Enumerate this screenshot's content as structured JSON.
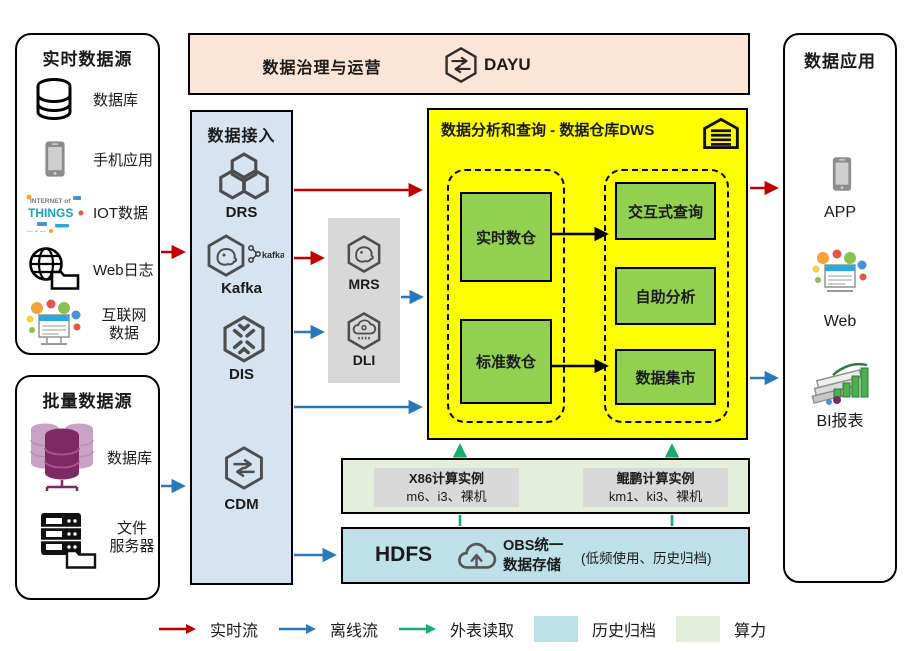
{
  "colors": {
    "realtime_flow": "#C00000",
    "offline_flow": "#2878BE",
    "external_read": "#16AD70",
    "archive_fill": "#BEE0E8",
    "compute_fill": "#E3EFDA",
    "dws_fill": "#FEFE00",
    "module_green": "#92D050",
    "governance_fill": "#FBE5D6",
    "ingest_fill": "#D6E3F1",
    "processing_fill": "#D8D8D8"
  },
  "realtime_sources": {
    "title": "实时数据源",
    "items": [
      {
        "icon": "database-icon",
        "label": "数据库"
      },
      {
        "icon": "mobile-phone-icon",
        "label": "手机应用"
      },
      {
        "icon": "iot-wordcloud-icon",
        "label": "IOT数据"
      },
      {
        "icon": "globe-folder-icon",
        "label": "Web日志"
      },
      {
        "icon": "internet-bubbles-icon",
        "label": "互联网数据",
        "lines": [
          "互联网",
          "数据"
        ]
      }
    ]
  },
  "batch_sources": {
    "title": "批量数据源",
    "items": [
      {
        "icon": "database-stack-icon",
        "label": "数据库"
      },
      {
        "icon": "file-server-icon",
        "label": "文件服务器",
        "lines": [
          "文件",
          "服务器"
        ]
      }
    ]
  },
  "governance": {
    "title": "数据治理与运营",
    "product": "DAYU"
  },
  "ingest": {
    "title": "数据接入",
    "services": [
      {
        "icon": "drs-hexagons-icon",
        "name": "DRS"
      },
      {
        "icon": "kafka-hexagon-icon",
        "name": "Kafka",
        "logo_text": "kafka"
      },
      {
        "icon": "dis-hexagon-icon",
        "name": "DIS"
      },
      {
        "icon": "cdm-hexagon-icon",
        "name": "CDM"
      }
    ]
  },
  "processing": {
    "services": [
      {
        "icon": "mrs-hexagon-icon",
        "name": "MRS"
      },
      {
        "icon": "dli-hexagon-icon",
        "name": "DLI"
      }
    ]
  },
  "dws": {
    "title": "数据分析和查询 - 数据仓库DWS",
    "left_group": [
      "实时数仓",
      "标准数仓"
    ],
    "right_group": [
      "交互式查询",
      "自助分析",
      "数据集市"
    ]
  },
  "compute": {
    "instances": [
      {
        "title": "X86计算实例",
        "spec": "m6、i3、裸机"
      },
      {
        "title": "鲲鹏计算实例",
        "spec": "km1、ki3、裸机"
      }
    ]
  },
  "storage": {
    "hdfs": "HDFS",
    "obs_lines": [
      "OBS统一",
      "数据存储"
    ],
    "note": "(低频使用、历史归档)"
  },
  "apps": {
    "title": "数据应用",
    "items": [
      {
        "icon": "app-phone-icon",
        "label": "APP"
      },
      {
        "icon": "web-bubbles-icon",
        "label": "Web"
      },
      {
        "icon": "bi-report-icon",
        "label": "BI报表"
      }
    ]
  },
  "legend": {
    "realtime": "实时流",
    "offline": "离线流",
    "external": "外表读取",
    "archive": "历史归档",
    "compute": "算力"
  }
}
